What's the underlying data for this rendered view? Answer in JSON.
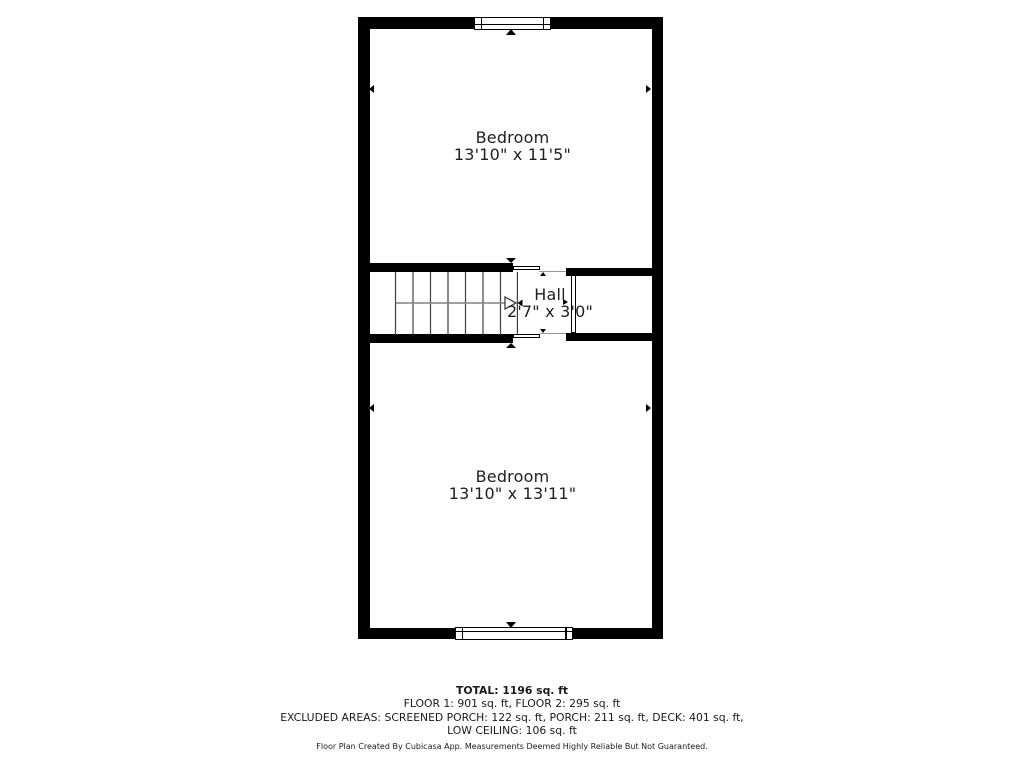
{
  "floor_plan": {
    "rooms": [
      {
        "name": "Bedroom",
        "dimensions": "13'10\" x 11'5\""
      },
      {
        "name": "Hall",
        "dimensions": "2'7\" x 3'0\""
      },
      {
        "name": "Bedroom",
        "dimensions": "13'10\" x 13'11\""
      }
    ]
  },
  "summary": {
    "total": "TOTAL: 1196 sq. ft",
    "floors": "FLOOR 1: 901 sq. ft, FLOOR 2: 295 sq. ft",
    "excluded_areas": "EXCLUDED AREAS: SCREENED PORCH: 122 sq. ft, PORCH: 211 sq. ft, DECK: 401 sq. ft,",
    "excluded_areas_cont": "LOW CEILING: 106 sq. ft",
    "disclaimer": "Floor Plan Created By Cubicasa App. Measurements Deemed Highly Reliable But Not Guaranteed."
  },
  "colors": {
    "wall": "#000000",
    "background": "#ffffff",
    "text": "#1f1f1f",
    "stair_line": "#3f3f3f",
    "stair_guide": "#808080"
  }
}
